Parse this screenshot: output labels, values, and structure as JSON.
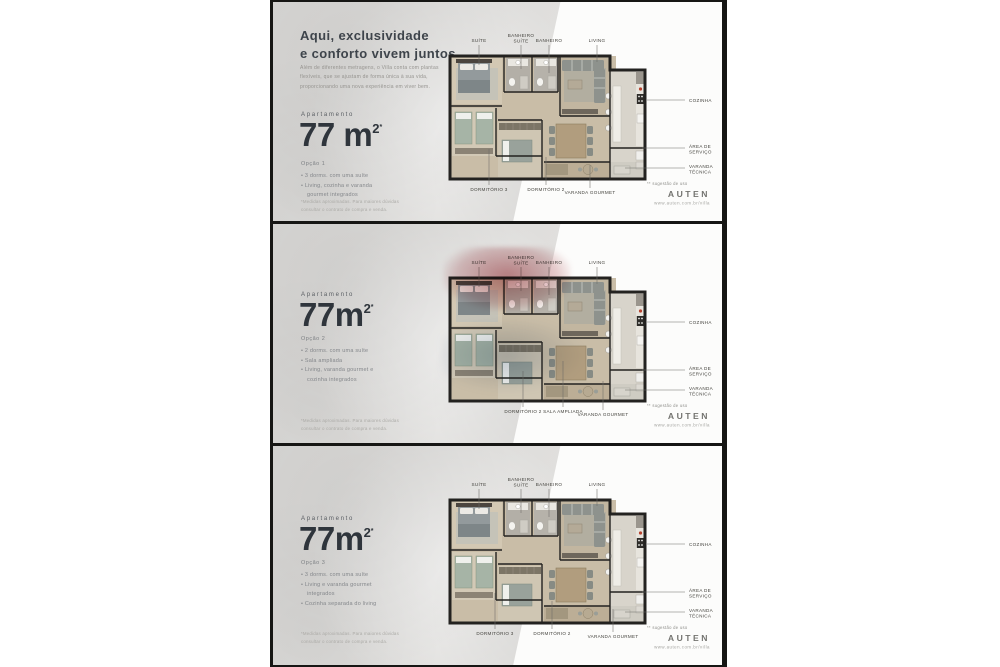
{
  "brand": {
    "logo_text": "AUTEN",
    "website": "www.auten.com.br/villa"
  },
  "intro": {
    "headline": "Aqui, exclusividade\ne conforto vivem juntos.",
    "paragraph": "Além de diferentes metragens, o Villa conta com plantas flexíveis, que se ajustam de forma única à sua vida, proporcionando uma nova experiência em viver bem."
  },
  "footnote": "*Medidas aproximadas. Para maiores dúvidas\nconsultar o contrato de compra e venda.",
  "plan_labels": {
    "suite": "SUÍTE",
    "bathroom_suite": [
      "BANHEIRO",
      "SUÍTE"
    ],
    "bathroom": "BANHEIRO",
    "living": "LIVING",
    "kitchen": "COZINHA",
    "service_area": [
      "ÁREA DE",
      "SERVIÇO"
    ],
    "technical_balcony": [
      "VARANDA",
      "TÉCNICA"
    ],
    "usage_note": "** sugestão de uso"
  },
  "panels": [
    {
      "apartment_label": "Apartamento",
      "area_value": "77 m",
      "area_exponent": "2",
      "area_mark": "*",
      "option_label": "Opção 1",
      "features": [
        "3 dorms. com uma suíte",
        "Living, cozinha e varanda gourmet integrados"
      ],
      "bottom_labels": [
        "DORMITÓRIO 3",
        "DORMITÓRIO 2",
        "VARANDA GOURMET"
      ]
    },
    {
      "apartment_label": "Apartamento",
      "area_value": "77m",
      "area_exponent": "2",
      "area_mark": "*",
      "option_label": "Opção 2",
      "features": [
        "2 dorms. com uma suíte",
        "Sala ampliada",
        "Living, varanda gourmet e cozinha integrados"
      ],
      "bottom_labels": [
        "DORMITÓRIO 2",
        "SALA AMPLIADA",
        "VARANDA GOURMET"
      ]
    },
    {
      "apartment_label": "Apartamento",
      "area_value": "77m",
      "area_exponent": "2",
      "area_mark": "*",
      "option_label": "Opção 3",
      "features": [
        "3 dorms. com uma suíte",
        "Living e varanda gourmet integrados",
        "Cozinha separada do living"
      ],
      "bottom_labels": [
        "DORMITÓRIO 3",
        "DORMITÓRIO 2",
        "VARANDA GOURMET"
      ]
    }
  ]
}
